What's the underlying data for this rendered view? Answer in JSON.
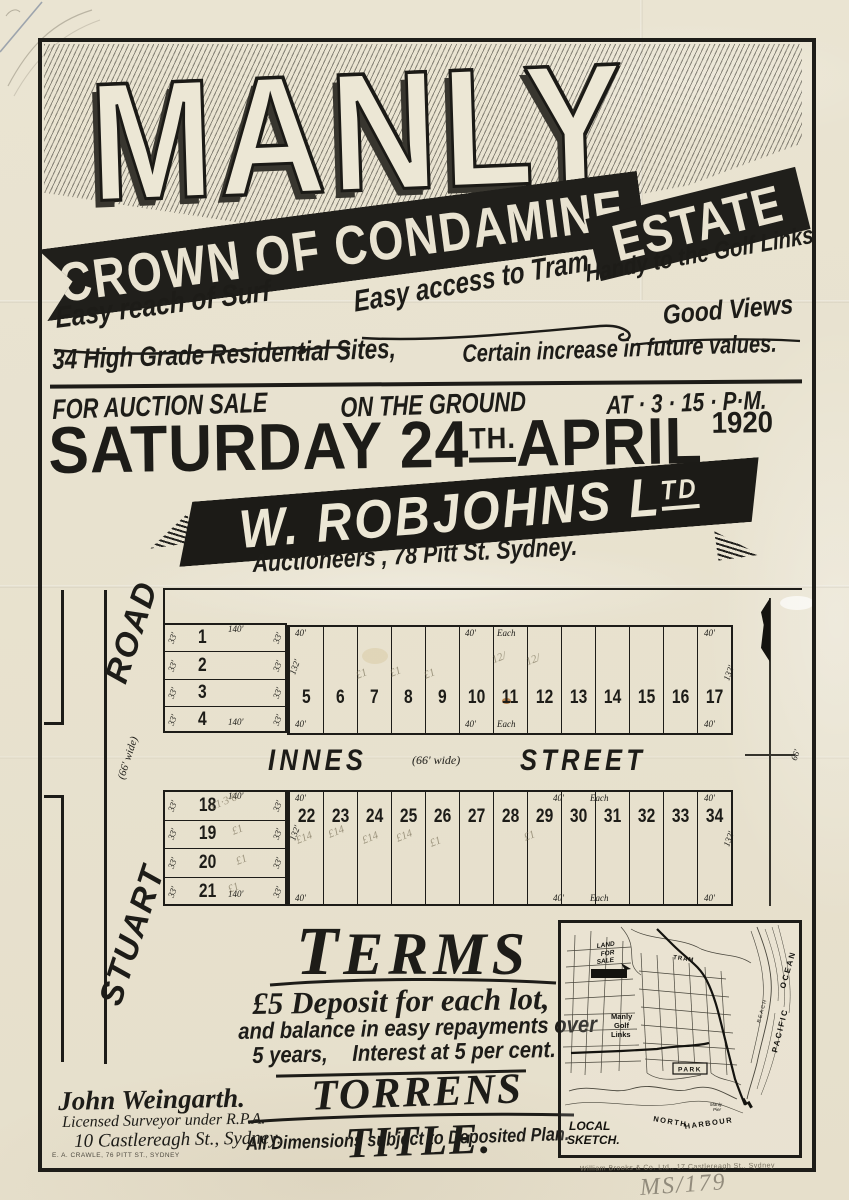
{
  "banner": {
    "title": "MANLY",
    "ribbon_top": "CROWN OF CONDAMINE",
    "ribbon_side": "ESTATE"
  },
  "features": {
    "surf": "Easy reach of Surf",
    "tram": "Easy access to Tram",
    "golf": "Handy to the Golf Links",
    "views": "Good Views",
    "sites": "34 High Grade Residential Sites,",
    "increase": "Certain increase in future values."
  },
  "auction": {
    "line_left": "FOR AUCTION SALE",
    "line_mid": "ON THE GROUND",
    "line_right": "AT · 3 · 15 · P·M.",
    "date_main": "SATURDAY 24",
    "date_sup": "TH.",
    "date_rest": "APRIL",
    "year": "1920"
  },
  "agent": {
    "name_main": "W. ROBJOHNS L",
    "name_sup": "TD",
    "subline": "Auctioneers , 78 Pitt St. Sydney."
  },
  "plan": {
    "road": {
      "top": "ROAD",
      "width": "(66' wide)",
      "bottom": "STUART"
    },
    "street": {
      "name_left": "INNES",
      "width": "(66' wide)",
      "name_right": "STREET",
      "east_dim": "66'"
    },
    "block1": {
      "rows": [
        {
          "n": "1",
          "s": "33'"
        },
        {
          "n": "2",
          "s": "33'"
        },
        {
          "n": "3",
          "s": "33'"
        },
        {
          "n": "4",
          "s": "33'"
        }
      ],
      "row_top": "140'",
      "row_bottom": "140'",
      "cols": [
        "5",
        "6",
        "7",
        "8",
        "9",
        "10",
        "11",
        "12",
        "13",
        "14",
        "15",
        "16",
        "17"
      ],
      "dim40": "40'",
      "each": "Each",
      "depth": "132'"
    },
    "block2": {
      "rows": [
        {
          "n": "18",
          "s": "33'"
        },
        {
          "n": "19",
          "s": "33'"
        },
        {
          "n": "20",
          "s": "33'"
        },
        {
          "n": "21",
          "s": "33'"
        }
      ],
      "row_top": "140'",
      "row_bottom": "140'",
      "cols": [
        "22",
        "23",
        "24",
        "25",
        "26",
        "27",
        "28",
        "29",
        "30",
        "31",
        "32",
        "33",
        "34"
      ],
      "dim40": "40'",
      "each": "Each",
      "depth": "132'"
    },
    "pencil": {
      "marks": [
        "£1",
        "£1",
        "£1",
        "12/",
        "12/",
        "£1·3·6",
        "£1",
        "£1",
        "£1",
        "£14",
        "£14",
        "£14",
        "£14",
        "£1",
        "£1"
      ]
    }
  },
  "terms": {
    "heading": "TERMS",
    "line1": "£5 Deposit for each lot,",
    "line2": "and balance in easy repayments over",
    "line3a": "5 years,",
    "line3b": "Interest at 5 per cent.",
    "title": "TORRENS TITLE.",
    "note": "All Dimensions subject to Deposited Plan."
  },
  "surveyor": {
    "name": "John Weingarth.",
    "line2": "Licensed Surveyor under R.P.A.",
    "line3": "10 Castlereagh St., Sydney.",
    "printer": "E. A. CRAWLE, 76 PITT ST., SYDNEY"
  },
  "sketch": {
    "land1": "LAND",
    "land2": "FOR",
    "land3": "SALE",
    "golf1": "Manly",
    "golf2": "Golf",
    "golf3": "Links",
    "tram": "TRAM",
    "park": "PARK",
    "beach": "BEACH",
    "ocean1": "PACIFIC",
    "ocean2": "OCEAN",
    "harbour1": "NORTH",
    "harbour2": "HARBOUR",
    "pier1": "Manly",
    "pier2": "Pier",
    "caption1": "LOCAL",
    "caption2": "SKETCH."
  },
  "footer": {
    "printer": "William Brooks & Co. Ltd., 17 Castlereagh St., Sydney",
    "catalog": "MS/179"
  }
}
